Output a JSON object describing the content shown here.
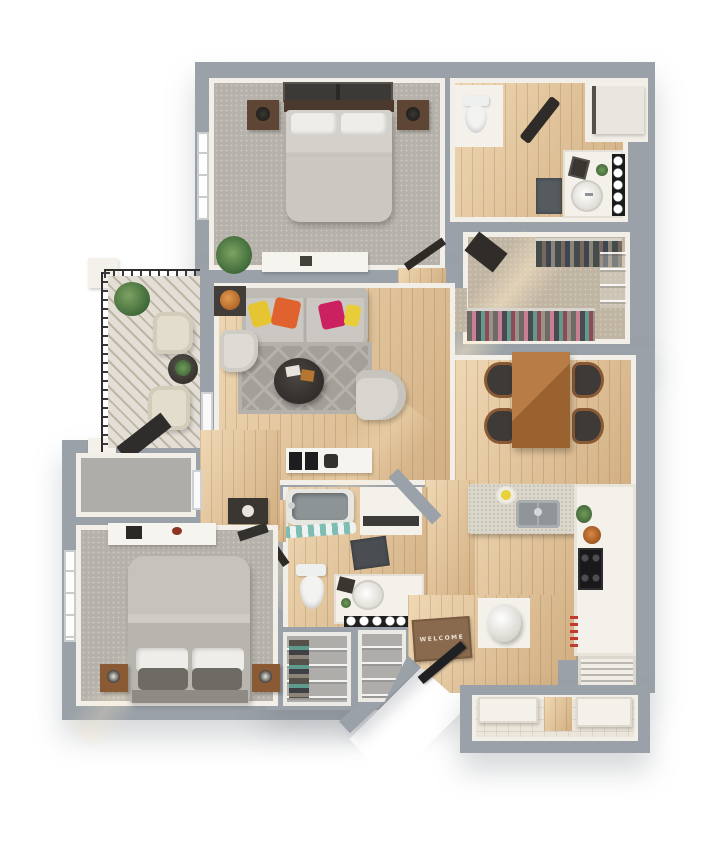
{
  "scene": {
    "type": "3d-floor-plan-render",
    "view": "top-down dollhouse",
    "unit": "two-bedroom apartment with balcony and patio storage"
  },
  "labels": {
    "welcome_mat": "WELCOME"
  },
  "palette": {
    "wall": "#9aa1a8",
    "wall_face": "#f2efe9",
    "hardwood": "#dcbd92",
    "carpet": "#b6b2ab",
    "closet_carpet": "#c0b4a2",
    "balcony_deck": "#d1cabb",
    "area_rug": "#a39f99",
    "sofa": "#cbc7c2",
    "pillow_yellow": "#e5c531",
    "pillow_orange": "#e0622e",
    "pillow_magenta": "#cb2160",
    "dining_wood": "#aa7140",
    "island_marble": "#dcd7cb",
    "counter_white": "#f5f2ec",
    "appliance_dark": "#19191b",
    "door_dark": "#1f2023",
    "welcome_mat_brown": "#8a6a4e",
    "patio_tile": "#ece6da",
    "shower_curtain_teal": "#7fbdb2"
  },
  "rooms": [
    {
      "name": "bedroom-1",
      "floor": "carpet",
      "furniture": [
        "queen-bed",
        "headboard",
        "wall-art-frames",
        "nightstand-left",
        "nightstand-right",
        "table-lamps",
        "dresser",
        "potted-plant",
        "window",
        "door"
      ]
    },
    {
      "name": "bathroom-1",
      "floor": "hardwood",
      "furniture": [
        "toilet",
        "vanity-sink",
        "mirror-lights",
        "bath-mat",
        "hanging-robes",
        "wall-art",
        "plant"
      ]
    },
    {
      "name": "laundry-closet",
      "floor": "hardwood",
      "furniture": [
        "sliding-door"
      ]
    },
    {
      "name": "walk-in-closet",
      "floor": "carpet",
      "furniture": [
        "clothes-rack-top",
        "clothes-rack-bottom",
        "wire-shelving",
        "bench"
      ]
    },
    {
      "name": "living-room",
      "floor": "hardwood",
      "furniture": [
        "sofa",
        "accent-pillows",
        "area-rug",
        "coffee-table",
        "armchair",
        "accent-chair",
        "side-table-with-lamp",
        "media-console",
        "speakers",
        "balcony-door"
      ]
    },
    {
      "name": "balcony",
      "floor": "deck",
      "furniture": [
        "metal-railing",
        "lounge-chair-1",
        "lounge-chair-2",
        "side-table",
        "potted-plant",
        "door-mat"
      ]
    },
    {
      "name": "dining-area",
      "floor": "hardwood",
      "furniture": [
        "dining-table",
        "dining-chair-x4"
      ]
    },
    {
      "name": "kitchen",
      "floor": "hardwood",
      "furniture": [
        "island",
        "double-sink",
        "fruit-bowl",
        "range-stove",
        "copper-pot",
        "plant",
        "utensil-rail",
        "counter"
      ]
    },
    {
      "name": "bathroom-2",
      "floor": "hardwood",
      "furniture": [
        "bathtub",
        "shower-curtain",
        "toilet",
        "vanity-sink",
        "vanity-lights",
        "bath-mat",
        "shelf-alcove"
      ]
    },
    {
      "name": "bedroom-2",
      "floor": "carpet",
      "furniture": [
        "queen-bed",
        "pillows",
        "nightstand-left",
        "nightstand-right",
        "desk",
        "bench",
        "window"
      ]
    },
    {
      "name": "entry",
      "floor": "hardwood",
      "furniture": [
        "welcome-mat",
        "front-door",
        "round-pedestal-table"
      ]
    },
    {
      "name": "storage-closet",
      "floor": "concrete",
      "furniture": [
        "door"
      ]
    },
    {
      "name": "linen-closet-a",
      "floor": "concrete",
      "furniture": [
        "wire-shelves",
        "hanging-clothes"
      ]
    },
    {
      "name": "linen-closet-b",
      "floor": "concrete",
      "furniture": [
        "wire-shelves"
      ]
    },
    {
      "name": "utility-closet",
      "floor": "hardwood",
      "furniture": [
        "louvered-door"
      ]
    },
    {
      "name": "patio-storage",
      "floor": "tile",
      "furniture": [
        "water-heater",
        "hvac-unit"
      ]
    }
  ]
}
